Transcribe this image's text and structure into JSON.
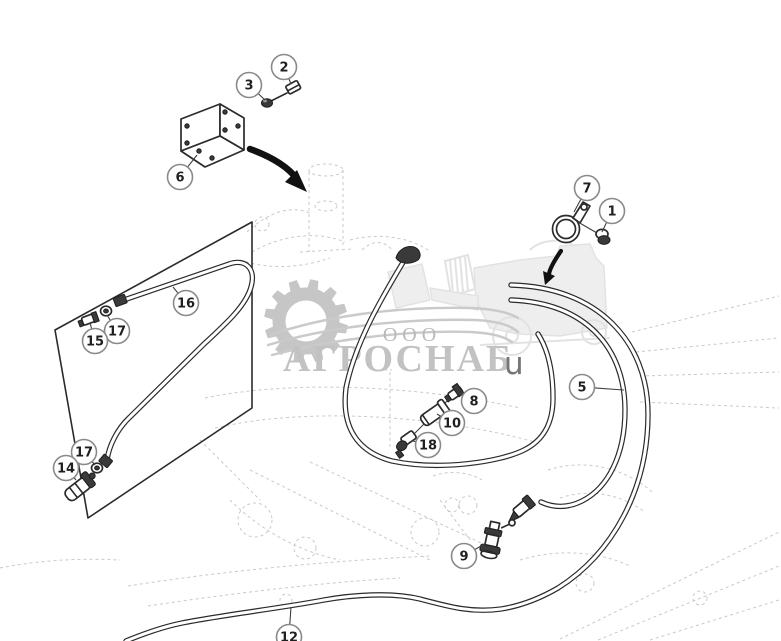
{
  "watermark": {
    "company_prefix": "ООО",
    "company_name": "АГРОСНАБ",
    "suffix_letter": "u",
    "icons": [
      "gear-icon",
      "combine-harvester-icon"
    ]
  },
  "colors": {
    "line": "#2b2b2b",
    "ghost": "#c9c9c9",
    "callout_border": "#8a8a8a",
    "callout_text": "#1f1f1f",
    "watermark_gray": "#c6c6c6",
    "watermark_text": "#c2c2c2",
    "watermark_letter": "#757575"
  },
  "diagram": {
    "type": "exploded-parts-diagram",
    "callouts": [
      {
        "label": "2",
        "x": 284,
        "y": 67,
        "tx": 291,
        "ty": 84
      },
      {
        "label": "3",
        "x": 249,
        "y": 85,
        "tx": 265,
        "ty": 100
      },
      {
        "label": "6",
        "x": 180,
        "y": 177,
        "tx": 197,
        "ty": 155
      },
      {
        "label": "7",
        "x": 587,
        "y": 188,
        "tx": 574,
        "ty": 212
      },
      {
        "label": "1",
        "x": 612,
        "y": 211,
        "tx": 602,
        "ty": 232
      },
      {
        "label": "16",
        "x": 186,
        "y": 303,
        "tx": 173,
        "ty": 287
      },
      {
        "label": "17",
        "x": 117,
        "y": 331,
        "tx": 107,
        "ty": 315
      },
      {
        "label": "15",
        "x": 95,
        "y": 341,
        "tx": 90,
        "ty": 323
      },
      {
        "label": "5",
        "x": 582,
        "y": 387,
        "tx": 624,
        "ty": 390
      },
      {
        "label": "8",
        "x": 474,
        "y": 401,
        "tx": 459,
        "ty": 393
      },
      {
        "label": "10",
        "x": 452,
        "y": 423,
        "tx": 437,
        "ty": 414
      },
      {
        "label": "18",
        "x": 428,
        "y": 445,
        "tx": 413,
        "ty": 441
      },
      {
        "label": "17",
        "x": 84,
        "y": 452,
        "tx": 95,
        "ty": 465
      },
      {
        "label": "14",
        "x": 66,
        "y": 468,
        "tx": 76,
        "ty": 480
      },
      {
        "label": "9",
        "x": 464,
        "y": 556,
        "tx": 486,
        "ty": 543
      },
      {
        "label": "12",
        "x": 289,
        "y": 637,
        "tx": 291,
        "ty": 607
      }
    ]
  }
}
